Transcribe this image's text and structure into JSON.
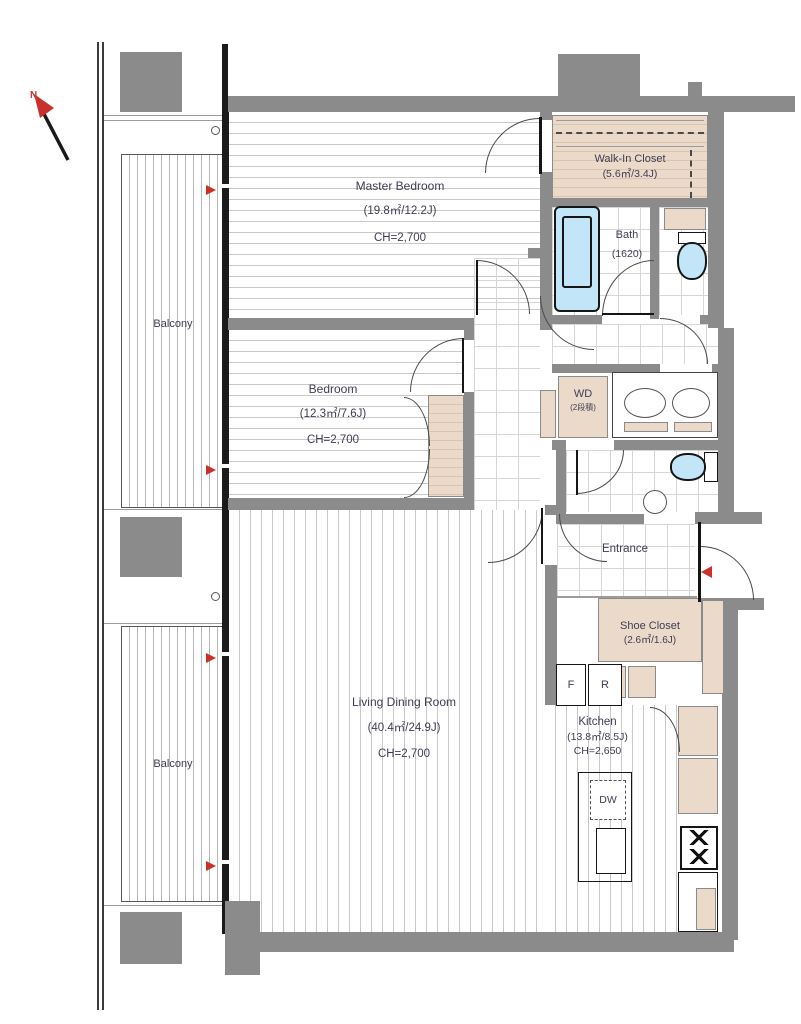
{
  "compass": {
    "north": "N"
  },
  "rooms": {
    "master_bedroom": {
      "name": "Master Bedroom",
      "area": "(19.8㎡/12.2J)",
      "ceiling": "CH=2,700"
    },
    "bedroom": {
      "name": "Bedroom",
      "area": "(12.3㎡/7.6J)",
      "ceiling": "CH=2,700"
    },
    "living_dining": {
      "name": "Living Dining Room",
      "area": "(40.4㎡/24.9J)",
      "ceiling": "CH=2,700"
    },
    "kitchen": {
      "name": "Kitchen",
      "area": "(13.8㎡/8.5J)",
      "ceiling": "CH=2,650"
    },
    "walk_in_closet": {
      "name": "Walk-In Closet",
      "area": "(5.6㎡/3.4J)"
    },
    "shoe_closet": {
      "name": "Shoe Closet",
      "area": "(2.6㎡/1.6J)"
    },
    "bath": {
      "name": "Bath",
      "size": "(1620)"
    },
    "entrance": {
      "name": "Entrance"
    },
    "balcony_upper": {
      "name": "Balcony"
    },
    "balcony_lower": {
      "name": "Balcony"
    }
  },
  "fixtures": {
    "washer_dryer": {
      "label": "WD",
      "note": "(2段積)"
    },
    "freezer": "F",
    "refrigerator": "R",
    "dishwasher": "DW"
  },
  "colors": {
    "wall": "#8b8b8b",
    "closet_fill": "#ebdac9",
    "water_fixture": "#c2e6f7",
    "accent_red": "#c9322b",
    "text": "#3d3d55"
  }
}
